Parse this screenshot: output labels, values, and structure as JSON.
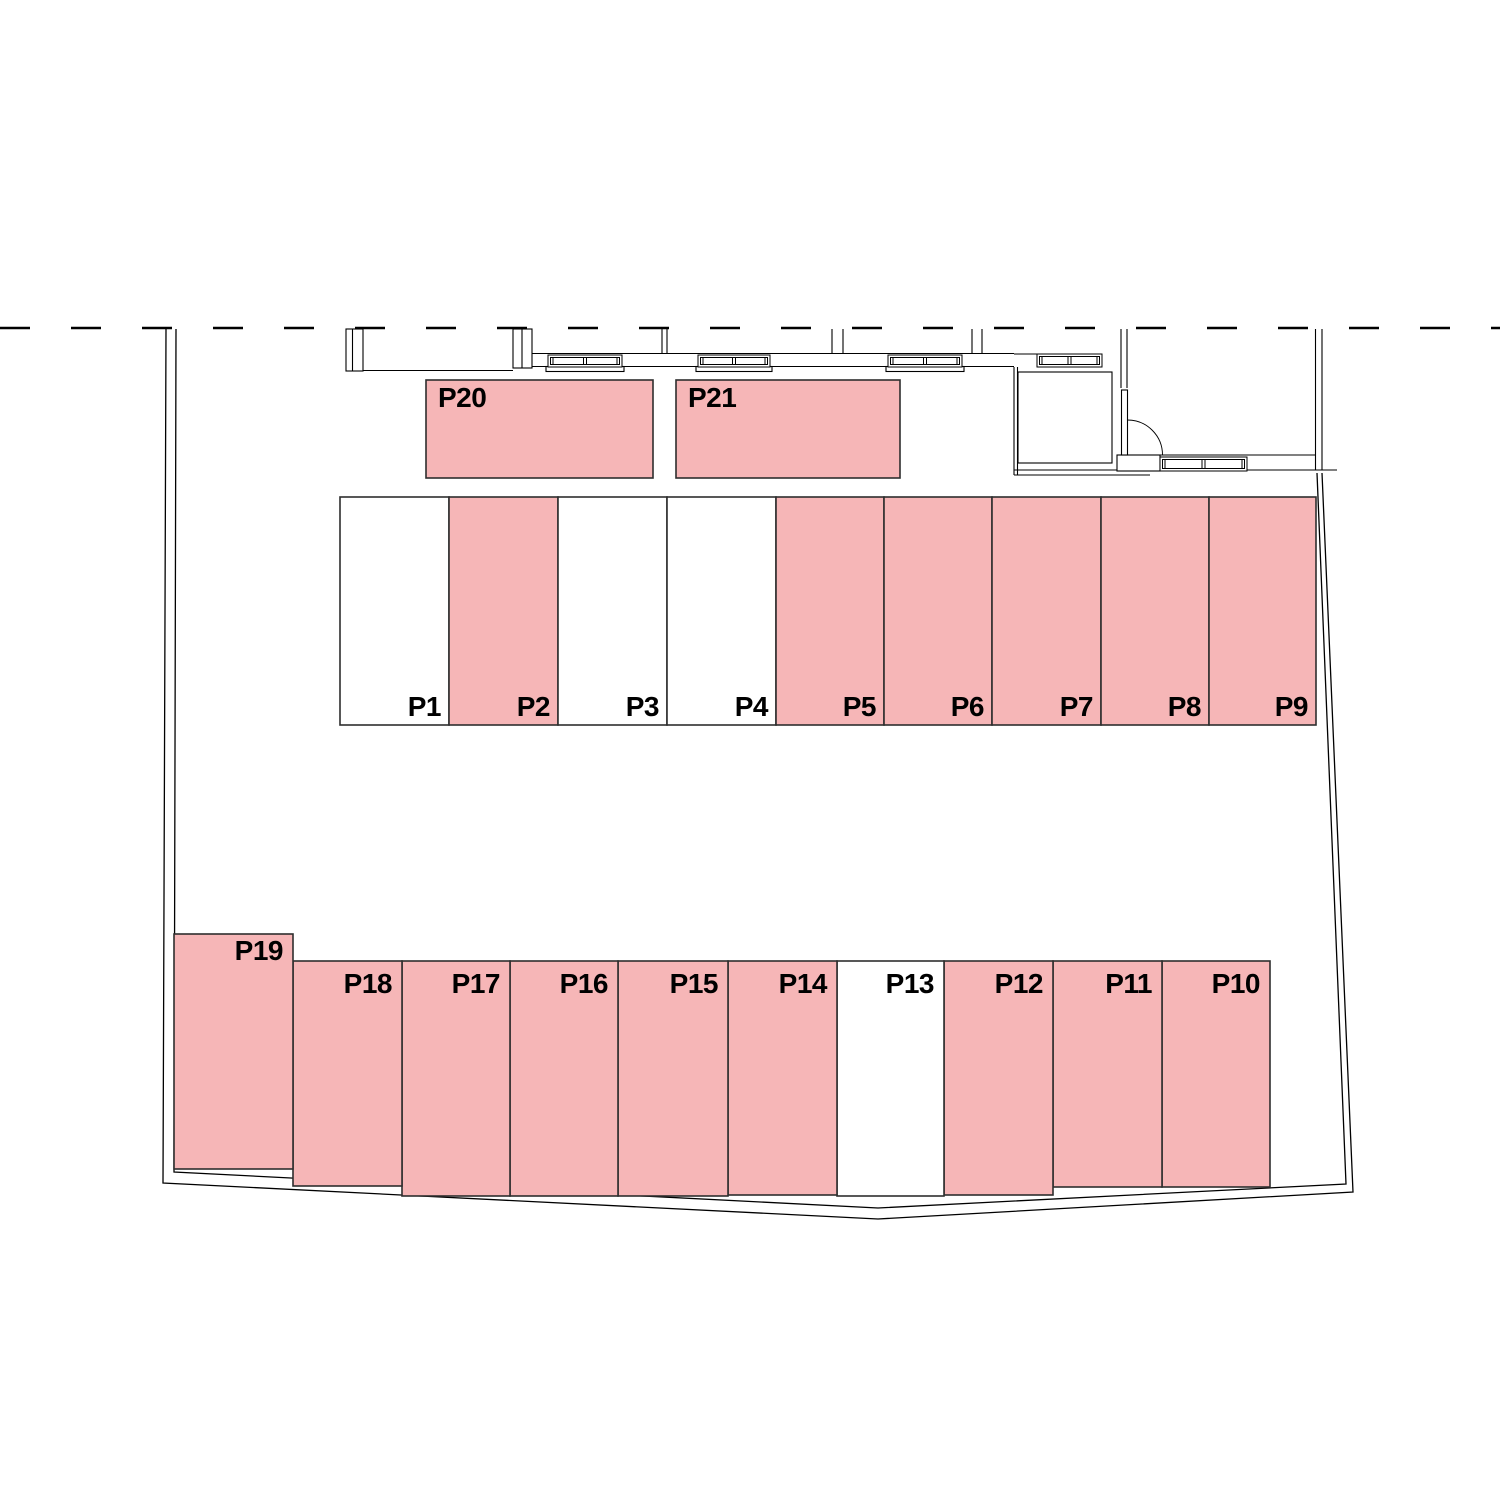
{
  "plan": {
    "name": "parking-site-plan",
    "colors": {
      "stall_fill": "#f6b6b7",
      "stall_empty_fill": "#ffffff",
      "stall_stroke": "#2e2e2e",
      "line": "#000000",
      "label": "#000000",
      "background": "#ffffff"
    },
    "stalls": [
      {
        "id": "P1",
        "label": "P1",
        "x": 340,
        "y": 497,
        "w": 109,
        "h": 228,
        "filled": false,
        "anchor": "br",
        "lx": 441,
        "ly": 716
      },
      {
        "id": "P2",
        "label": "P2",
        "x": 449,
        "y": 497,
        "w": 109,
        "h": 228,
        "filled": true,
        "anchor": "br",
        "lx": 550,
        "ly": 716
      },
      {
        "id": "P3",
        "label": "P3",
        "x": 558,
        "y": 497,
        "w": 109,
        "h": 228,
        "filled": false,
        "anchor": "br",
        "lx": 659,
        "ly": 716
      },
      {
        "id": "P4",
        "label": "P4",
        "x": 667,
        "y": 497,
        "w": 109,
        "h": 228,
        "filled": false,
        "anchor": "br",
        "lx": 768,
        "ly": 716
      },
      {
        "id": "P5",
        "label": "P5",
        "x": 776,
        "y": 497,
        "w": 108,
        "h": 228,
        "filled": true,
        "anchor": "br",
        "lx": 876,
        "ly": 716
      },
      {
        "id": "P6",
        "label": "P6",
        "x": 884,
        "y": 497,
        "w": 108,
        "h": 228,
        "filled": true,
        "anchor": "br",
        "lx": 984,
        "ly": 716
      },
      {
        "id": "P7",
        "label": "P7",
        "x": 992,
        "y": 497,
        "w": 109,
        "h": 228,
        "filled": true,
        "anchor": "br",
        "lx": 1093,
        "ly": 716
      },
      {
        "id": "P8",
        "label": "P8",
        "x": 1101,
        "y": 497,
        "w": 108,
        "h": 228,
        "filled": true,
        "anchor": "br",
        "lx": 1201,
        "ly": 716
      },
      {
        "id": "P9",
        "label": "P9",
        "x": 1209,
        "y": 497,
        "w": 107,
        "h": 228,
        "filled": true,
        "anchor": "br",
        "lx": 1308,
        "ly": 716
      },
      {
        "id": "P10",
        "label": "P10",
        "x": 1162,
        "y": 961,
        "w": 108,
        "h": 226,
        "filled": true,
        "anchor": "tr",
        "lx": 1260,
        "ly": 993
      },
      {
        "id": "P11",
        "label": "P11",
        "x": 1053,
        "y": 961,
        "w": 109,
        "h": 226,
        "filled": true,
        "anchor": "tr",
        "lx": 1152,
        "ly": 993
      },
      {
        "id": "P12",
        "label": "P12",
        "x": 944,
        "y": 961,
        "w": 109,
        "h": 234,
        "filled": true,
        "anchor": "tr",
        "lx": 1043,
        "ly": 993
      },
      {
        "id": "P13",
        "label": "P13",
        "x": 837,
        "y": 961,
        "w": 107,
        "h": 235,
        "filled": false,
        "anchor": "tr",
        "lx": 934,
        "ly": 993
      },
      {
        "id": "P14",
        "label": "P14",
        "x": 728,
        "y": 961,
        "w": 109,
        "h": 234,
        "filled": true,
        "anchor": "tr",
        "lx": 827,
        "ly": 993
      },
      {
        "id": "P15",
        "label": "P15",
        "x": 618,
        "y": 961,
        "w": 110,
        "h": 235,
        "filled": true,
        "anchor": "tr",
        "lx": 718,
        "ly": 993
      },
      {
        "id": "P16",
        "label": "P16",
        "x": 510,
        "y": 961,
        "w": 108,
        "h": 235,
        "filled": true,
        "anchor": "tr",
        "lx": 608,
        "ly": 993
      },
      {
        "id": "P17",
        "label": "P17",
        "x": 402,
        "y": 961,
        "w": 108,
        "h": 235,
        "filled": true,
        "anchor": "tr",
        "lx": 500,
        "ly": 993
      },
      {
        "id": "P18",
        "label": "P18",
        "x": 293,
        "y": 961,
        "w": 109,
        "h": 225,
        "filled": true,
        "anchor": "tr",
        "lx": 392,
        "ly": 993
      },
      {
        "id": "P19",
        "label": "P19",
        "x": 174,
        "y": 934,
        "w": 119,
        "h": 235,
        "filled": true,
        "anchor": "tr",
        "lx": 283,
        "ly": 960
      },
      {
        "id": "P20",
        "label": "P20",
        "x": 426,
        "y": 380,
        "w": 227,
        "h": 98,
        "filled": true,
        "anchor": "tl",
        "lx": 438,
        "ly": 407
      },
      {
        "id": "P21",
        "label": "P21",
        "x": 676,
        "y": 380,
        "w": 224,
        "h": 98,
        "filled": true,
        "anchor": "tl",
        "lx": 688,
        "ly": 407
      }
    ]
  }
}
